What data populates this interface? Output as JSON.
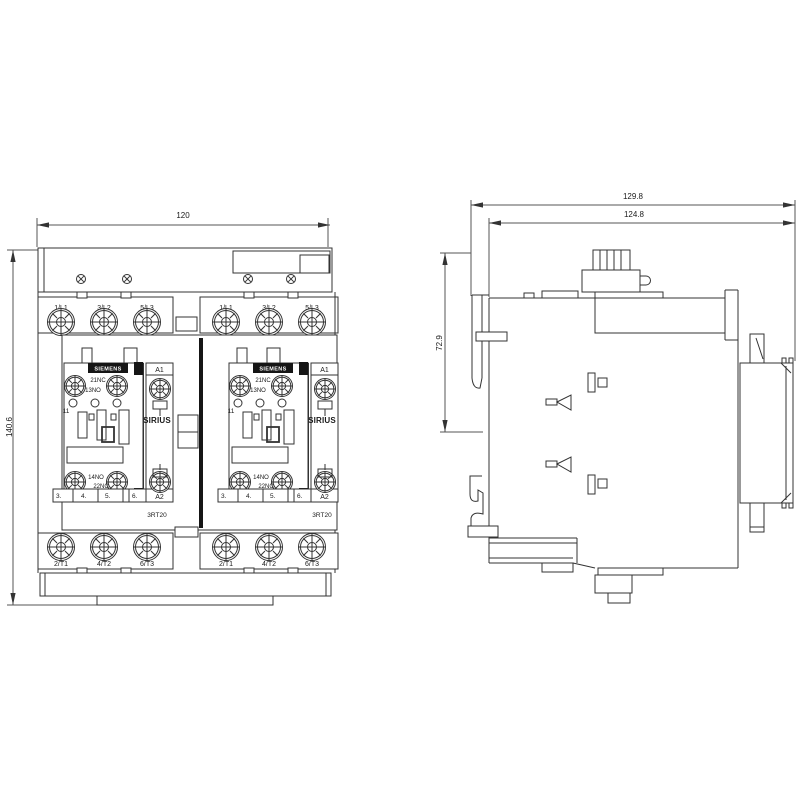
{
  "front_view": {
    "width_dim": "120",
    "height_dim": "140.6",
    "top_terminals": [
      "1/L1",
      "3/L2",
      "5/L3"
    ],
    "bottom_terminals": [
      "2/T1",
      "4/T2",
      "6/T3"
    ],
    "unit": {
      "brand": "SIEMENS",
      "series": "SIRIUS",
      "model": "3RT20",
      "coil_a1": "A1",
      "coil_a2": "A2",
      "aux_21nc": "21NC",
      "aux_13no": "13NO",
      "aux_14no": "14NO",
      "aux_22nc": "22NC",
      "aux_index": "11",
      "pole_numbers": [
        "3.",
        "4.",
        "5.",
        "6."
      ]
    }
  },
  "side_view": {
    "overall_depth_dim": "129.8",
    "rail_depth_dim": "124.8",
    "upper_height_dim": "72.9"
  },
  "colors": {
    "line": "#333333",
    "label_bg": "#151515",
    "label_text": "#ffffff",
    "background": "#ffffff"
  }
}
